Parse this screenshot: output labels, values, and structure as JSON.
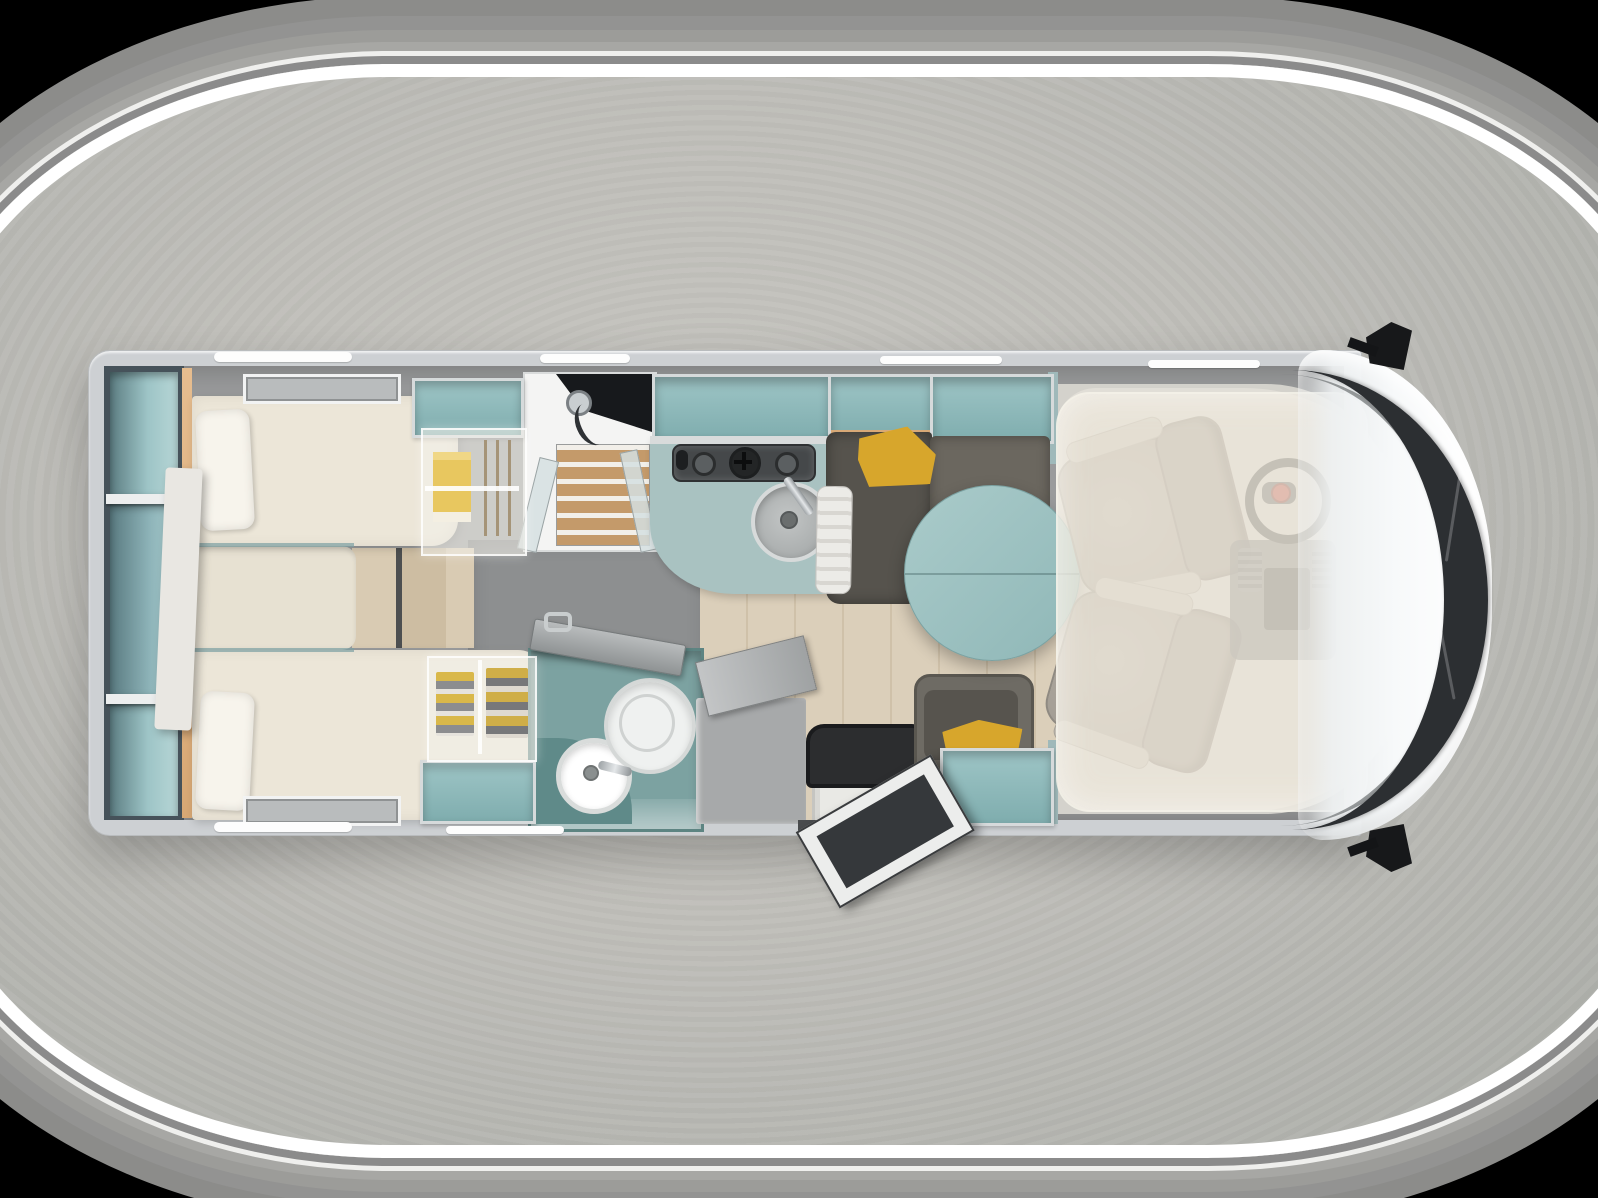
{
  "image_type": "3d-top-view-motorhome-floorplan",
  "visible_text": [],
  "palette": {
    "ring_white": "#ffffff",
    "bg_center": "#c7c6c1",
    "bg_edge": "#8a8f8a",
    "wall_gray": "#cdd0d3",
    "floor_gray": "#9a9b9c",
    "carpet": "#8d8f90",
    "wood_light": "#dbcfba",
    "wood_teak": "#c49a6a",
    "wood_edge": "#e6bd8f",
    "bed_cream": "#ece6d8",
    "teal_cabinet": "#8fb9ba",
    "teal_table": "#9cc2c2",
    "teal_bathroom": "#7ca2a1",
    "counter": "#a9c2c1",
    "sofa_dark": "#56534d",
    "sofa_mid": "#6b675f",
    "mustard": "#d7a62c",
    "seat_gray": "#a8a29a",
    "cab_white": "#f6f8f9",
    "glass_dark": "#2c2f32",
    "step_dark": "#2c2d2f",
    "fiat_red": "#b93a32"
  },
  "regions": [
    {
      "name": "rear-shelving",
      "kind": "open teal shelving, 3 bays"
    },
    {
      "name": "twin-bed-upper",
      "kind": "single bed with pillow"
    },
    {
      "name": "twin-bed-lower",
      "kind": "single bed with pillow"
    },
    {
      "name": "center-step-cushion",
      "kind": "cushion between beds"
    },
    {
      "name": "wardrobe-upper",
      "kind": "translucent wardrobe, yellow towels and hangers"
    },
    {
      "name": "wardrobe-lower",
      "kind": "translucent wardrobe, hanging clothes"
    },
    {
      "name": "shower-room",
      "kind": "shower with teak slat floor and glass doors"
    },
    {
      "name": "kitchen",
      "kind": "teal counter, 3-burner hob, round sink"
    },
    {
      "name": "overhead-cabinets",
      "kind": "open teal lockers along walls"
    },
    {
      "name": "dinette-sofa",
      "kind": "dark gray lounge with mustard cushion"
    },
    {
      "name": "dinette-table",
      "kind": "round teal pedestal table"
    },
    {
      "name": "side-seat",
      "kind": "single travel seat with mustard cushion and teal box"
    },
    {
      "name": "bathroom",
      "kind": "teal washroom, round basin, toilet, open door"
    },
    {
      "name": "entry",
      "kind": "open entry door with step"
    },
    {
      "name": "cab",
      "kind": "two swivel pilot seats, steering wheel with red badge, dashboard"
    },
    {
      "name": "drop-down-bed",
      "kind": "translucent bed lowered over cab"
    },
    {
      "name": "windshield",
      "kind": "dark curved glass at nose"
    },
    {
      "name": "mirrors",
      "kind": "black wing mirrors top and bottom"
    }
  ]
}
